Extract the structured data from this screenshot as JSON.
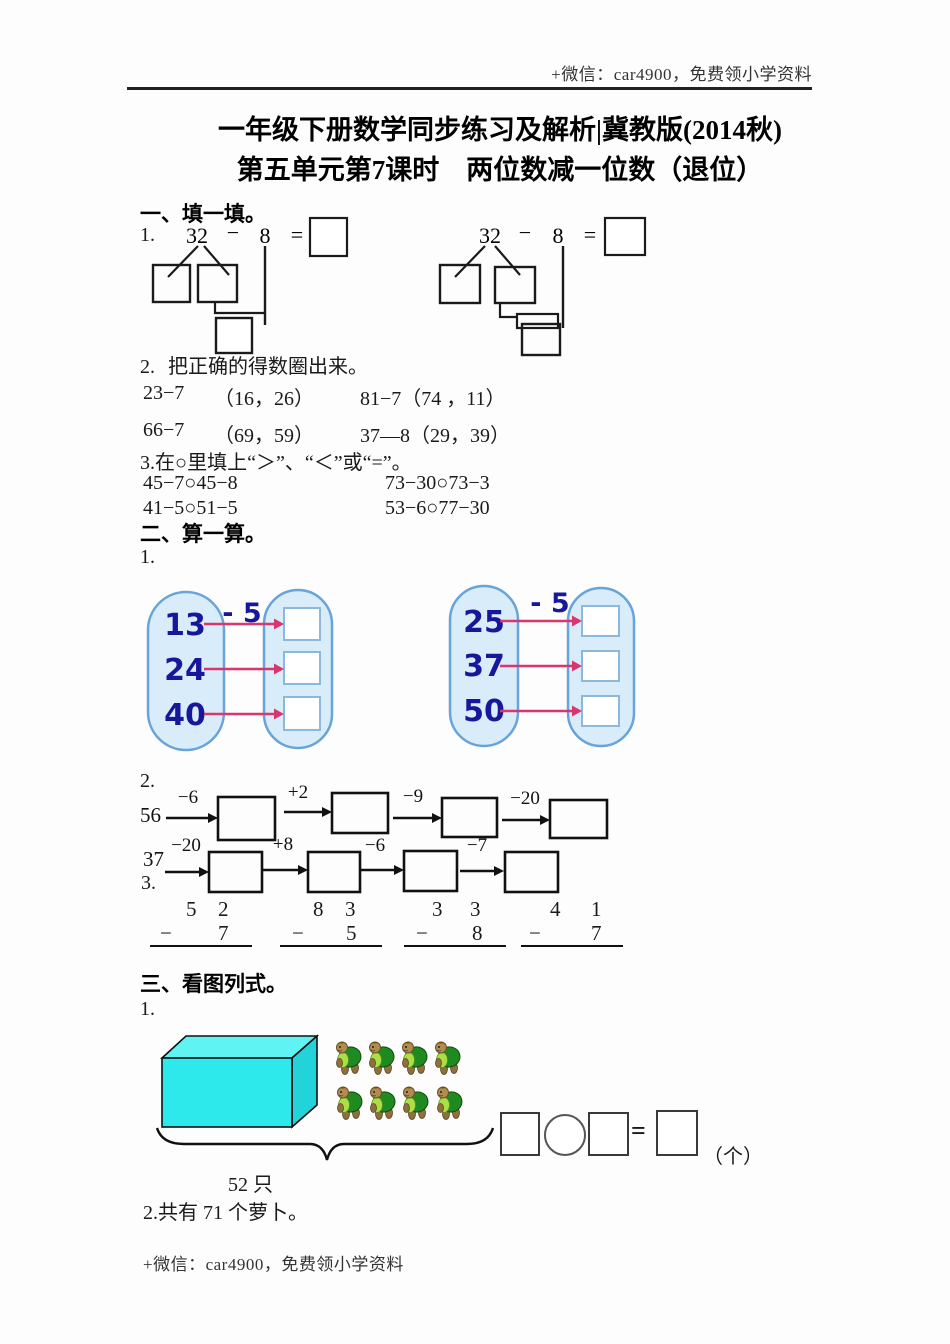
{
  "header": {
    "promo": "+微信：car4900，免费领小学资料"
  },
  "titles": {
    "line1": "一年级下册数学同步练习及解析|冀教版(2014秋)",
    "line2": "第五单元第7课时　两位数减一位数（退位）"
  },
  "section_one": {
    "heading": "一、填一填。",
    "q1": {
      "label": "1.",
      "left": {
        "minuend": "32",
        "minus": "−",
        "subtrahend": "8",
        "equals": "="
      },
      "right": {
        "minuend": "32",
        "minus": "−",
        "subtrahend": "8",
        "equals": "="
      }
    },
    "q2": {
      "label": "2.",
      "text": "把正确的得数圈出来。",
      "rows": [
        {
          "left_expr": "23−7",
          "left_choices": "（16，26）",
          "right": "81−7（74 ，11）"
        },
        {
          "left_expr": "66−7",
          "left_choices": "（69，59）",
          "right": "37—8（29，39）"
        }
      ]
    },
    "q3": {
      "text": "3.在○里填上“＞”、“＜”或“=”。",
      "rows": [
        {
          "left": "45−7○45−8",
          "right": "73−30○73−3"
        },
        {
          "left": "41−5○51−5",
          "right": "53−6○77−30"
        }
      ]
    }
  },
  "section_two": {
    "heading": "二、算一算。",
    "q1": {
      "label": "1.",
      "machines": [
        {
          "op": "- 5",
          "inputs": [
            "13",
            "24",
            "40"
          ]
        },
        {
          "op": "- 5",
          "inputs": [
            "25",
            "37",
            "50"
          ]
        }
      ]
    },
    "q2": {
      "label": "2.",
      "chains": [
        {
          "start": "56",
          "ops": [
            "−6",
            "+2",
            "−9",
            "−20"
          ]
        },
        {
          "start": "37",
          "ops": [
            "−20",
            "+8",
            "−6",
            "−7"
          ]
        }
      ]
    },
    "q3": {
      "label": "3.",
      "columns": [
        {
          "tens": "5",
          "ones": "2",
          "minus": "−",
          "subtrahend": "7"
        },
        {
          "tens": "8",
          "ones": "3",
          "minus": "−",
          "subtrahend": "5"
        },
        {
          "tens": "3",
          "ones": "3",
          "minus": "−",
          "subtrahend": "8"
        },
        {
          "tens": "4",
          "ones": "1",
          "minus": "−",
          "subtrahend": "7"
        }
      ]
    }
  },
  "section_three": {
    "heading": "三、看图列式。",
    "q1": {
      "label": "1.",
      "brace_label": "52 只",
      "equals": "=",
      "unit": "（个）"
    },
    "q2": {
      "text": "2.共有 71 个萝卜。"
    }
  },
  "footer": {
    "promo": "+微信：car4900，免费领小学资料"
  },
  "colors": {
    "capsule_fill": "#d9ecf9",
    "capsule_border": "#68a4d9",
    "number_navy": "#17179c",
    "arrow_pink": "#d9356e",
    "box_cyan_front": "#2de9ec",
    "box_cyan_top": "#5ff3f4",
    "box_cyan_side": "#22d3da"
  }
}
